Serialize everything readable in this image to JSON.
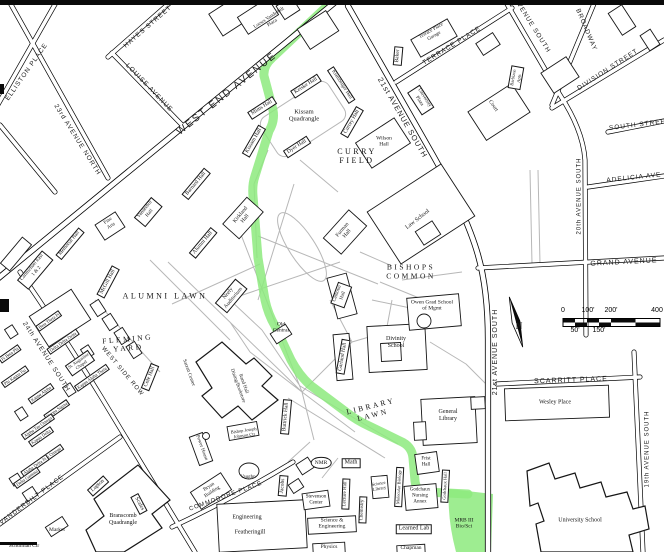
{
  "colors": {
    "route_highlight_green": "#8dea7e",
    "road_line": "#000000",
    "walkway_gray": "#b7b7b7",
    "background": "#ffffff",
    "text": "#141414"
  },
  "labels": [
    {
      "t": "ELLISTON PLACE",
      "x": 27,
      "y": 72,
      "r": -55,
      "s": 6.5,
      "c": "st"
    },
    {
      "t": "23rd AVENUE NORTH",
      "x": 77,
      "y": 140,
      "r": 58,
      "s": 6.5,
      "c": "st"
    },
    {
      "t": "HAYES STREET",
      "x": 148,
      "y": 27,
      "r": -41,
      "s": 6.5,
      "c": "st"
    },
    {
      "t": "LOUISE AVENUE",
      "x": 149,
      "y": 88,
      "r": 46,
      "s": 6.5,
      "c": "st"
    },
    {
      "t": "WEST END AVENUE",
      "x": 227,
      "y": 94,
      "r": -39,
      "s": 10,
      "c": "st",
      "ls": 2
    },
    {
      "t": "21st AVENUE SOUTH",
      "x": 402,
      "y": 118,
      "r": 60,
      "s": 7.5,
      "c": "st"
    },
    {
      "t": "21st AVENUE SOUTH",
      "x": 496,
      "y": 352,
      "r": -90,
      "s": 7,
      "c": "st"
    },
    {
      "t": "TERRACE PLACE",
      "x": 452,
      "y": 46,
      "r": -32,
      "s": 6.5,
      "c": "st"
    },
    {
      "t": "AVENUE SOUTH",
      "x": 532,
      "y": 26,
      "r": 58,
      "s": 6.5,
      "c": "st"
    },
    {
      "t": "BROADWAY",
      "x": 586,
      "y": 30,
      "r": 67,
      "s": 6.5,
      "c": "st"
    },
    {
      "t": "DIVISION STREET",
      "x": 608,
      "y": 70,
      "r": -33,
      "s": 6.5,
      "c": "st"
    },
    {
      "t": "SOUTH STREET",
      "x": 640,
      "y": 125,
      "r": -7,
      "s": 6.5,
      "c": "st"
    },
    {
      "t": "ADELICIA AVE",
      "x": 634,
      "y": 178,
      "r": -6,
      "s": 6.5,
      "c": "st"
    },
    {
      "t": "20th AVENUE SOUTH",
      "x": 580,
      "y": 196,
      "r": -90,
      "s": 6,
      "c": "st"
    },
    {
      "t": "GRAND AVENUE",
      "x": 624,
      "y": 263,
      "r": -3,
      "s": 7,
      "c": "st"
    },
    {
      "t": "SCARRITT PLACE",
      "x": 571,
      "y": 381,
      "r": -2,
      "s": 7,
      "c": "st"
    },
    {
      "t": "19th AVENUE SOUTH",
      "x": 648,
      "y": 449,
      "r": -90,
      "s": 6,
      "c": "st"
    },
    {
      "t": "24th AVENUE SOUTH",
      "x": 46,
      "y": 357,
      "r": 57,
      "s": 6.5,
      "c": "st"
    },
    {
      "t": "VANDERBILT PLACE",
      "x": 32,
      "y": 500,
      "r": -37,
      "s": 6.5,
      "c": "st"
    },
    {
      "t": "WEST SIDE ROW",
      "x": 122,
      "y": 372,
      "r": 50,
      "s": 6,
      "c": "st"
    },
    {
      "t": "COMMODORE PLACE",
      "x": 226,
      "y": 497,
      "r": -20,
      "s": 6,
      "c": "st"
    },
    {
      "t": "CURRY\nFIELD",
      "x": 357,
      "y": 156,
      "r": 0,
      "s": 8,
      "c": "ar"
    },
    {
      "t": "ALUMNI LAWN",
      "x": 165,
      "y": 296,
      "r": 0,
      "s": 8,
      "c": "ar"
    },
    {
      "t": "FLEMING\nYARD",
      "x": 128,
      "y": 344,
      "r": -5,
      "s": 7.5,
      "c": "ar"
    },
    {
      "t": "BISHOPS\nCOMMON",
      "x": 411,
      "y": 272,
      "r": 0,
      "s": 7.5,
      "c": "ar"
    },
    {
      "t": "LIBRARY\nLAWN",
      "x": 372,
      "y": 411,
      "r": -14,
      "s": 7.5,
      "c": "ar"
    },
    {
      "t": "Kissam\nQuadrangle",
      "x": 304,
      "y": 116,
      "r": 0,
      "s": 6.5,
      "c": "b"
    },
    {
      "t": "Loews Vanderbilt\nPlaza",
      "x": 271,
      "y": 21,
      "r": -33,
      "s": 5,
      "c": "b"
    },
    {
      "t": "Terrace Place\nGarage",
      "x": 433,
      "y": 34,
      "r": -30,
      "s": 5,
      "c": "b"
    },
    {
      "t": "Court",
      "x": 493,
      "y": 106,
      "r": 55,
      "s": 5.5,
      "c": "b"
    },
    {
      "t": "Wilson\nHall",
      "x": 384,
      "y": 142,
      "r": 0,
      "s": 5.5,
      "c": "b"
    },
    {
      "t": "Kirkland\nHall",
      "x": 243,
      "y": 217,
      "r": -50,
      "s": 5.5,
      "c": "b"
    },
    {
      "t": "Furman\nHall",
      "x": 345,
      "y": 232,
      "r": -50,
      "s": 5.5,
      "c": "b"
    },
    {
      "t": "Law School",
      "x": 418,
      "y": 220,
      "r": -38,
      "s": 6,
      "c": "b"
    },
    {
      "t": "Owen Grad School\nof Mgmt",
      "x": 432,
      "y": 306,
      "r": 0,
      "s": 5.5,
      "c": "b"
    },
    {
      "t": "Old\nCentral",
      "x": 281,
      "y": 328,
      "r": 0,
      "s": 5.5,
      "c": "b"
    },
    {
      "t": "Divinity\nSchool",
      "x": 396,
      "y": 343,
      "r": 0,
      "s": 6,
      "c": "b"
    },
    {
      "t": "General\nLibrary",
      "x": 448,
      "y": 416,
      "r": 0,
      "s": 6,
      "c": "b"
    },
    {
      "t": "Rand Hall\nDining/Bookstore",
      "x": 240,
      "y": 385,
      "r": 70,
      "s": 5,
      "c": "b"
    },
    {
      "t": "Sarratt Center",
      "x": 188,
      "y": 373,
      "r": 70,
      "s": 5,
      "c": "b"
    },
    {
      "t": "NMR",
      "x": 321,
      "y": 463,
      "r": 0,
      "s": 5.5,
      "c": "b circ"
    },
    {
      "t": "Science\nLibrary",
      "x": 379,
      "y": 486,
      "r": -10,
      "s": 4.5,
      "c": "b"
    },
    {
      "t": "Stevenson\nCenter",
      "x": 316,
      "y": 500,
      "r": 0,
      "s": 5,
      "c": "b"
    },
    {
      "t": "Science &\nEngineering",
      "x": 332,
      "y": 524,
      "r": 0,
      "s": 5.5,
      "c": "b"
    },
    {
      "t": "Physics",
      "x": 329,
      "y": 547,
      "r": 0,
      "s": 5.5,
      "c": "b"
    },
    {
      "t": "Chapman",
      "x": 411,
      "y": 548,
      "r": 0,
      "s": 5.5,
      "c": "b"
    },
    {
      "t": "Frist\nHall",
      "x": 426,
      "y": 462,
      "r": 0,
      "s": 5,
      "c": "b"
    },
    {
      "t": "Godchaux\nNursing\nAnnex",
      "x": 420,
      "y": 496,
      "r": 0,
      "s": 5,
      "c": "b"
    },
    {
      "t": "MRB III\nBio/Sci",
      "x": 464,
      "y": 524,
      "r": 0,
      "s": 5.5,
      "c": "b"
    },
    {
      "t": "Wesley Place",
      "x": 555,
      "y": 403,
      "r": 0,
      "s": 6,
      "c": "b"
    },
    {
      "t": "University School",
      "x": 580,
      "y": 521,
      "r": 0,
      "s": 6,
      "c": "b"
    },
    {
      "t": "Bryan\nBuilding",
      "x": 211,
      "y": 490,
      "r": -33,
      "s": 5,
      "c": "b"
    },
    {
      "t": "Power House",
      "x": 201,
      "y": 448,
      "r": 70,
      "s": 5,
      "c": "b"
    },
    {
      "t": "Vaughn",
      "x": 248,
      "y": 478,
      "r": 0,
      "s": 5,
      "c": "b"
    },
    {
      "t": "Bishop Joseph\nJohnson Ctr",
      "x": 244,
      "y": 433,
      "r": -8,
      "s": 4.5,
      "c": "b"
    },
    {
      "t": "Engineering",
      "x": 247,
      "y": 518,
      "r": 0,
      "s": 6,
      "c": "b"
    },
    {
      "t": "Featheringill",
      "x": 250,
      "y": 533,
      "r": 0,
      "s": 6,
      "c": "b"
    },
    {
      "t": "Branscomb\nQuadrangle",
      "x": 123,
      "y": 520,
      "r": 0,
      "s": 6,
      "c": "b"
    },
    {
      "t": "Market",
      "x": 57,
      "y": 530,
      "r": 0,
      "s": 5.5,
      "c": "b"
    },
    {
      "t": "Schulman Ctr",
      "x": 24,
      "y": 546,
      "r": 0,
      "s": 5.5,
      "c": "b"
    },
    {
      "t": "Mims Hall",
      "x": 262,
      "y": 108,
      "r": -33,
      "s": 5.5,
      "c": "bx"
    },
    {
      "t": "Keiske Hall",
      "x": 306,
      "y": 86,
      "r": -33,
      "s": 5.5,
      "c": "bx"
    },
    {
      "t": "Klamberger Hall",
      "x": 341,
      "y": 85,
      "r": 57,
      "s": 5,
      "c": "bx"
    },
    {
      "t": "Currey Hall",
      "x": 352,
      "y": 122,
      "r": -60,
      "s": 5.5,
      "c": "bx"
    },
    {
      "t": "Kissam Hall",
      "x": 254,
      "y": 141,
      "r": -60,
      "s": 5.5,
      "c": "bx"
    },
    {
      "t": "Dyer Hall",
      "x": 297,
      "y": 147,
      "r": -33,
      "s": 5.5,
      "c": "bx"
    },
    {
      "t": "Barnard Hall",
      "x": 196,
      "y": 184,
      "r": -50,
      "s": 5.5,
      "c": "bx"
    },
    {
      "t": "Vanderbilt\nHall",
      "x": 148,
      "y": 212,
      "r": -50,
      "s": 5,
      "c": "bx"
    },
    {
      "t": "Alumni Hall",
      "x": 203,
      "y": 243,
      "r": -50,
      "s": 5.5,
      "c": "bx"
    },
    {
      "t": "Memorial Hall",
      "x": 70,
      "y": 244,
      "r": -50,
      "s": 5,
      "c": "bx"
    },
    {
      "t": "Fine\nArts",
      "x": 110,
      "y": 224,
      "r": -33,
      "s": 5,
      "c": "b"
    },
    {
      "t": "Carmichael East\n1 & 2",
      "x": 35,
      "y": 270,
      "r": -50,
      "s": 5,
      "c": "bx"
    },
    {
      "t": "McGill Hall",
      "x": 108,
      "y": 282,
      "r": -62,
      "s": 5.5,
      "c": "bx"
    },
    {
      "t": "Cole Hall",
      "x": 150,
      "y": 377,
      "r": -68,
      "s": 5.5,
      "c": "bx"
    },
    {
      "t": "Neely\nAuditorium",
      "x": 231,
      "y": 296,
      "r": -50,
      "s": 5.5,
      "c": "bx"
    },
    {
      "t": "Baker",
      "x": 398,
      "y": 56,
      "r": -85,
      "s": 5.5,
      "c": "bx"
    },
    {
      "t": "University\nPlaza",
      "x": 421,
      "y": 100,
      "r": 57,
      "s": 5,
      "c": "bx"
    },
    {
      "t": "Barbizon\nApts",
      "x": 516,
      "y": 78,
      "r": -80,
      "s": 4.5,
      "c": "bx"
    },
    {
      "t": "Buttrick Hall",
      "x": 286,
      "y": 417,
      "r": -85,
      "s": 5.5,
      "c": "bx"
    },
    {
      "t": "Lecture Hall",
      "x": 346,
      "y": 494,
      "r": -88,
      "s": 5,
      "c": "bx"
    },
    {
      "t": "Molecular Biology",
      "x": 399,
      "y": 487,
      "r": -87,
      "s": 4.5,
      "c": "bx"
    },
    {
      "t": "Chemistry",
      "x": 363,
      "y": 510,
      "r": -88,
      "s": 5,
      "c": "bx"
    },
    {
      "t": "Godchaux Hall",
      "x": 445,
      "y": 486,
      "r": -87,
      "s": 4.5,
      "c": "bx"
    },
    {
      "t": "Jacobs",
      "x": 283,
      "y": 486,
      "r": -85,
      "s": 5.5,
      "c": "bx"
    },
    {
      "t": "Lupton",
      "x": 98,
      "y": 486,
      "r": -42,
      "s": 5.5,
      "c": "bx"
    },
    {
      "t": "Scales",
      "x": 139,
      "y": 504,
      "r": 62,
      "s": 5.5,
      "c": "bx"
    },
    {
      "t": "Math",
      "x": 351,
      "y": 463,
      "r": 0,
      "s": 6,
      "c": "bx"
    },
    {
      "t": "Learned Lab",
      "x": 414,
      "y": 529,
      "r": 0,
      "s": 6,
      "c": "bx"
    },
    {
      "t": "Garland Hall",
      "x": 343,
      "y": 357,
      "r": -80,
      "s": 5.5,
      "c": "bx"
    },
    {
      "t": "Calhoun\nHall",
      "x": 341,
      "y": 295,
      "r": -70,
      "s": 5,
      "c": "bx"
    },
    {
      "t": "Pi Beta Phi",
      "x": 10,
      "y": 354,
      "r": -35,
      "s": 4.5,
      "c": "g"
    },
    {
      "t": "Phi Kappa Psi",
      "x": 15,
      "y": 377,
      "r": -35,
      "s": 4.5,
      "c": "g"
    },
    {
      "t": "Beta Theta Pi",
      "x": 49,
      "y": 321,
      "r": -35,
      "s": 4.5,
      "c": "g"
    },
    {
      "t": "Delta Delta Delta",
      "x": 63,
      "y": 342,
      "r": -35,
      "s": 4.5,
      "c": "g"
    },
    {
      "t": "St. Augustine\nChapel",
      "x": 80,
      "y": 363,
      "r": -35,
      "s": 4.5,
      "c": "g"
    },
    {
      "t": "Kappa Alpha Theta",
      "x": 92,
      "y": 378,
      "r": -35,
      "s": 4.5,
      "c": "g"
    },
    {
      "t": "Kappa Alpha",
      "x": 41,
      "y": 394,
      "r": -35,
      "s": 4.5,
      "c": "g"
    },
    {
      "t": "Kappa Sigma",
      "x": 57,
      "y": 410,
      "r": -35,
      "s": 4.5,
      "c": "g"
    },
    {
      "t": "Alpha Tau Omega",
      "x": 38,
      "y": 427,
      "r": -35,
      "s": 4.5,
      "c": "g"
    },
    {
      "t": "Kappa Delta",
      "x": 41,
      "y": 437,
      "r": -35,
      "s": 4.5,
      "c": "g"
    },
    {
      "t": "Chi Omega",
      "x": 52,
      "y": 454,
      "r": -35,
      "s": 4.5,
      "c": "g"
    },
    {
      "t": "Alpha Delta Pi",
      "x": 35,
      "y": 466,
      "r": -35,
      "s": 4.5,
      "c": "g"
    },
    {
      "t": "Delta Gamma",
      "x": 27,
      "y": 478,
      "r": -35,
      "s": 4.5,
      "c": "g"
    },
    {
      "t": "0",
      "x": 563,
      "y": 311,
      "r": 0,
      "s": 7,
      "c": "sc"
    },
    {
      "t": "100'",
      "x": 588,
      "y": 311,
      "r": 0,
      "s": 7,
      "c": "sc"
    },
    {
      "t": "200'",
      "x": 611,
      "y": 311,
      "r": 0,
      "s": 7,
      "c": "sc"
    },
    {
      "t": "400",
      "x": 657,
      "y": 311,
      "r": 0,
      "s": 7,
      "c": "sc"
    },
    {
      "t": "50'",
      "x": 575,
      "y": 331,
      "r": 0,
      "s": 7,
      "c": "sc"
    },
    {
      "t": "150'",
      "x": 599,
      "y": 331,
      "r": 0,
      "s": 7,
      "c": "sc"
    },
    {
      "t": "N",
      "x": 519,
      "y": 326,
      "r": 0,
      "s": 9,
      "c": "n"
    }
  ]
}
